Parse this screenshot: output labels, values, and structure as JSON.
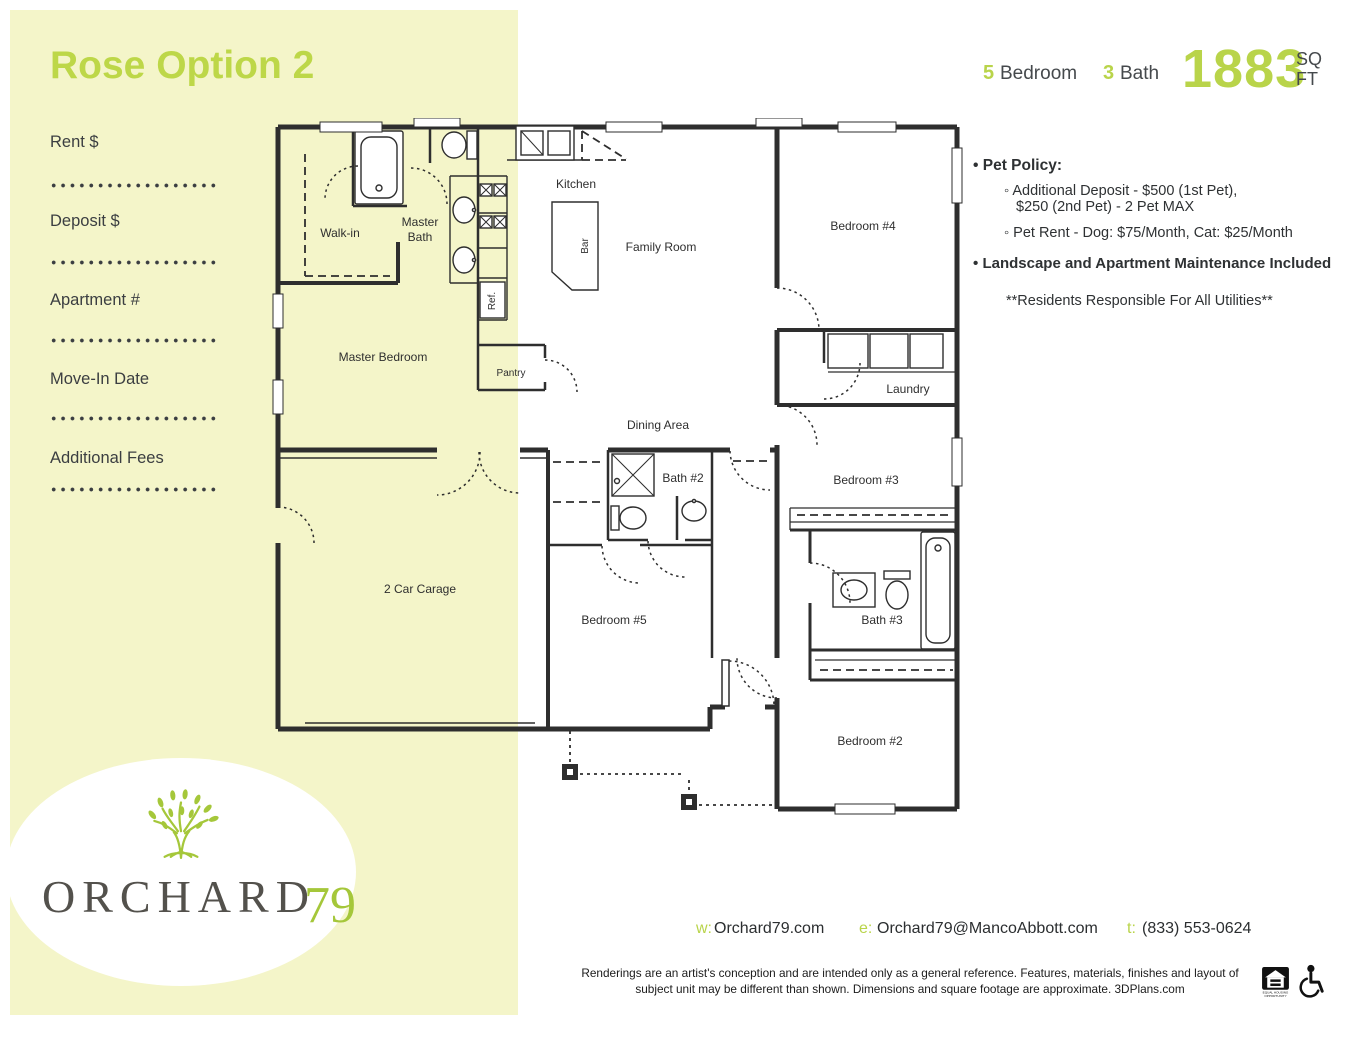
{
  "colors": {
    "accent_green": "#b9d44a",
    "panel_yellow": "#f4f5c9",
    "text_dark": "#3b3e41",
    "plan_line": "#2e2e2e"
  },
  "sidebar": {
    "title": "Rose Option 2",
    "fields": [
      {
        "label": "Rent $"
      },
      {
        "label": "Deposit $"
      },
      {
        "label": "Apartment #"
      },
      {
        "label": "Move-In Date"
      },
      {
        "label": "Additional Fees"
      }
    ]
  },
  "header": {
    "bed_num": "5",
    "bed_label": "Bedroom",
    "bath_num": "3",
    "bath_label": "Bath",
    "sqft": "1883",
    "sq": "SQ",
    "ft": "FT"
  },
  "details": {
    "bullet": "•",
    "sub_bullet": "◦",
    "pet_policy_heading": "Pet Policy:",
    "pet_deposit_line1": "Additional Deposit - $500 (1st Pet),",
    "pet_deposit_line2": "$250 (2nd Pet) - 2 Pet MAX",
    "pet_rent": "Pet Rent - Dog: $75/Month, Cat: $25/Month",
    "landscape": "Landscape and Apartment Maintenance Included",
    "utilities": "**Residents Responsible For All Utilities**"
  },
  "floorplan": {
    "rooms": {
      "walk_in": "Walk-in",
      "master_bath_line1": "Master",
      "master_bath_line2": "Bath",
      "kitchen": "Kitchen",
      "bar": "Bar",
      "family_room": "Family Room",
      "bedroom4": "Bedroom #4",
      "ref": "Ref.",
      "pantry": "Pantry",
      "master_bedroom": "Master Bedroom",
      "laundry": "Laundry",
      "dining": "Dining Area",
      "bath2": "Bath #2",
      "bedroom3": "Bedroom #3",
      "bath3": "Bath #3",
      "bedroom5": "Bedroom #5",
      "garage": "2 Car Carage",
      "bedroom2": "Bedroom #2"
    }
  },
  "logo": {
    "name": "ORCHARD",
    "number": "79"
  },
  "contact": {
    "web_label": "w:",
    "web": "Orchard79.com",
    "email_label": "e:",
    "email": "Orchard79@MancoAbbott.com",
    "phone_label": "t:",
    "phone": "(833) 553-0624"
  },
  "disclaimer": {
    "line1": "Renderings are an artist's conception and are intended only as a general reference. Features, materials, finishes and layout of",
    "line2": "subject unit may be different than shown. Dimensions and square footage are approximate. 3DPlans.com"
  }
}
